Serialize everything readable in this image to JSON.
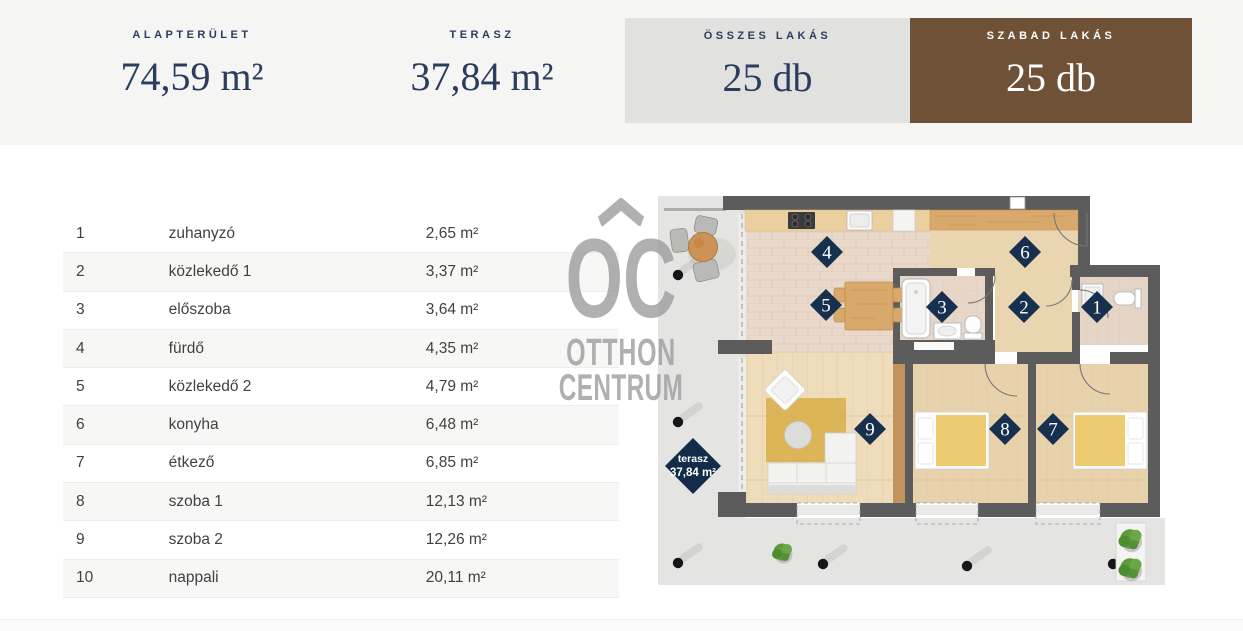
{
  "stats": [
    {
      "label": "ALAPTERÜLET",
      "value": "74,59 m²"
    },
    {
      "label": "TERASZ",
      "value": "37,84 m²"
    },
    {
      "label": "ÖSSZES LAKÁS",
      "value": "25 db"
    },
    {
      "label": "SZABAD LAKÁS",
      "value": "25 db"
    }
  ],
  "rooms": [
    {
      "num": "1",
      "name": "zuhanyzó",
      "area": "2,65 m²"
    },
    {
      "num": "2",
      "name": "közlekedő 1",
      "area": "3,37 m²"
    },
    {
      "num": "3",
      "name": "előszoba",
      "area": "3,64 m²"
    },
    {
      "num": "4",
      "name": "fürdő",
      "area": "4,35 m²"
    },
    {
      "num": "5",
      "name": "közlekedő 2",
      "area": "4,79 m²"
    },
    {
      "num": "6",
      "name": "konyha",
      "area": "6,48 m²"
    },
    {
      "num": "7",
      "name": "étkező",
      "area": "6,85 m²"
    },
    {
      "num": "8",
      "name": "szoba 1",
      "area": "12,13 m²"
    },
    {
      "num": "9",
      "name": "szoba 2",
      "area": "12,26 m²"
    },
    {
      "num": "10",
      "name": "nappali",
      "area": "20,11 m²"
    }
  ],
  "floorplan": {
    "diamonds": [
      "1",
      "2",
      "3",
      "4",
      "5",
      "6",
      "7",
      "8",
      "9"
    ],
    "terrace_label": {
      "name": "terasz",
      "area": "37,84 m²"
    },
    "watermark": {
      "monogram": "OC",
      "line1": "OTTHON",
      "line2": "CENTRUM"
    }
  },
  "colors": {
    "navy_text": "#2b3c5e",
    "brown_box": "#6f5138",
    "gray_box": "#e1e1e0",
    "diamond_navy": "#16304e",
    "wall_gray": "#5d5c5c",
    "terrace_gray": "#e4e4e2"
  }
}
